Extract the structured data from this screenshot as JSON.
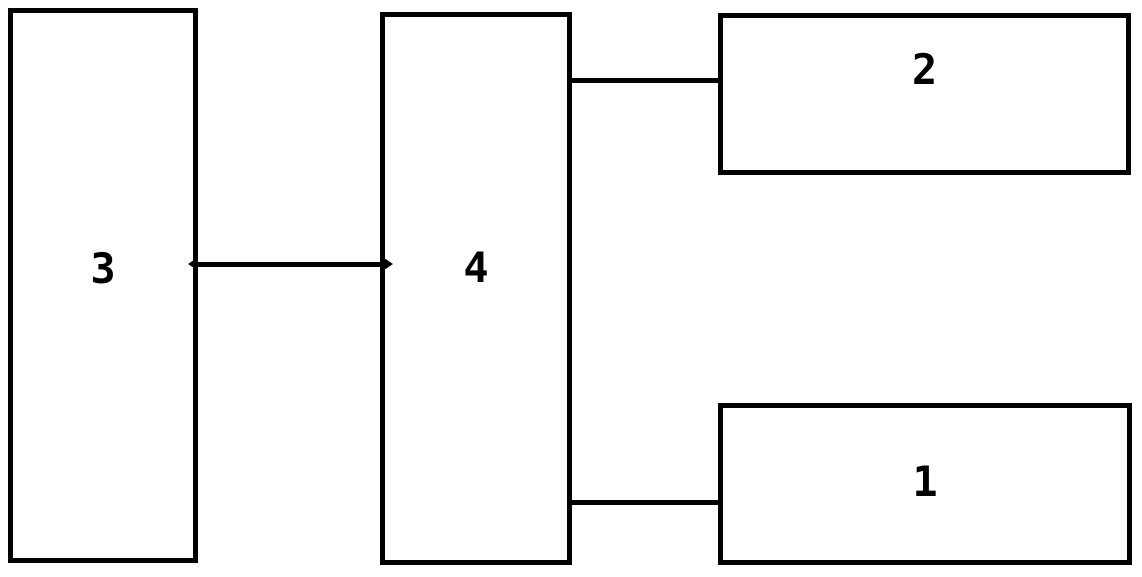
{
  "figure": {
    "type": "block-diagram",
    "background_color": "#ffffff",
    "stroke_color": "#000000",
    "nodes": [
      {
        "id": "1",
        "label": "1"
      },
      {
        "id": "2",
        "label": "2"
      },
      {
        "id": "3",
        "label": "3"
      },
      {
        "id": "4",
        "label": "4"
      }
    ],
    "edges": [
      {
        "from": "3",
        "to": "4",
        "style": "double-arrow"
      },
      {
        "from": "4",
        "to": "2",
        "style": "plain"
      },
      {
        "from": "4",
        "to": "1",
        "style": "plain"
      }
    ]
  }
}
